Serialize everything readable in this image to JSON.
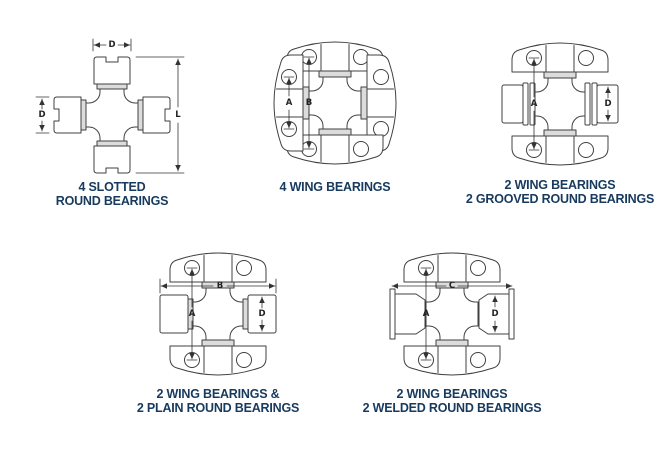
{
  "page": {
    "title": "Universal joint bearing type identification chart",
    "background": "#ffffff"
  },
  "colors": {
    "caption_text": "#173a5e",
    "diagram_line": "#404040",
    "shade": "#dcdcdc",
    "dimension_line": "#333333"
  },
  "diagrams": [
    {
      "id": "slotted-round",
      "caption_line1": "4 SLOTTED",
      "caption_line2": "ROUND BEARINGS",
      "dims": {
        "top_width": "D",
        "side_height": "D",
        "overall_length": "L"
      }
    },
    {
      "id": "four-wing",
      "caption_line1": "4 WING BEARINGS",
      "caption_line2": "",
      "dims": {
        "side_hole_span": "A",
        "main_hole_span": "B"
      }
    },
    {
      "id": "wing-grooved",
      "caption_line1": "2 WING BEARINGS",
      "caption_line2": "2 GROOVED ROUND BEARINGS",
      "dims": {
        "hole_span": "A",
        "cup_diameter": "D"
      }
    },
    {
      "id": "wing-plain",
      "caption_line1": "2 WING BEARINGS &",
      "caption_line2": "2 PLAIN ROUND BEARINGS",
      "dims": {
        "overall_width": "B",
        "hole_span": "A",
        "cup_diameter": "D"
      }
    },
    {
      "id": "wing-welded",
      "caption_line1": "2 WING BEARINGS",
      "caption_line2": "2 WELDED ROUND BEARINGS",
      "dims": {
        "overall_width": "C",
        "hole_span": "A",
        "cup_diameter": "D"
      }
    }
  ]
}
